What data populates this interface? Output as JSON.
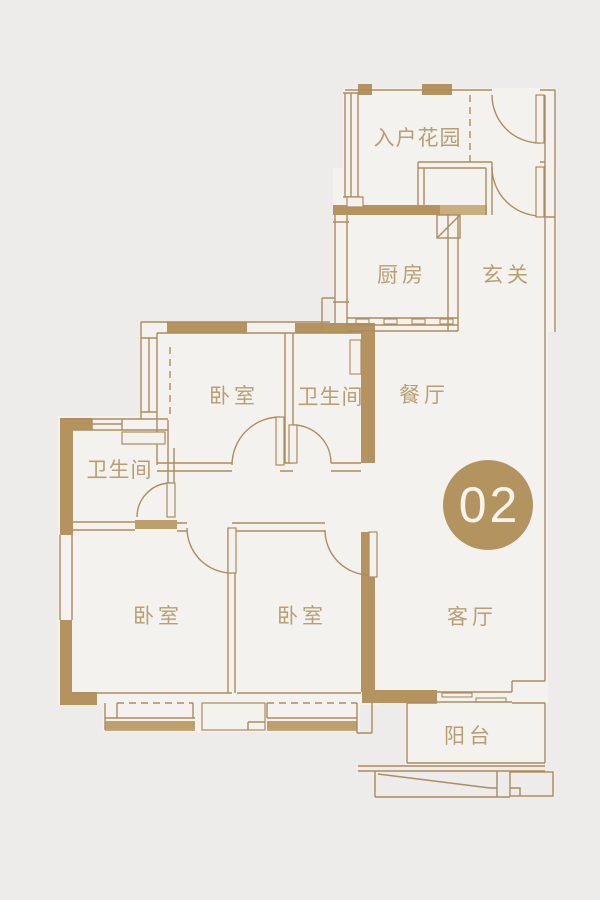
{
  "badge": {
    "number": "02"
  },
  "rooms": {
    "entry_garden": {
      "label": "入户花园"
    },
    "kitchen": {
      "label": "厨房"
    },
    "foyer": {
      "label": "玄关"
    },
    "bedroom_top": {
      "label": "卧室"
    },
    "bath_top": {
      "label": "卫生间"
    },
    "dining": {
      "label": "餐厅"
    },
    "bath_left": {
      "label": "卫生间"
    },
    "bedroom_left": {
      "label": "卧室"
    },
    "bedroom_mid": {
      "label": "卧室"
    },
    "living": {
      "label": "客厅"
    },
    "balcony": {
      "label": "阳台"
    }
  },
  "colors": {
    "background": "#edecea",
    "floor": "#f4f2ee",
    "line": "#ad8c5d",
    "wall": "#b4935f",
    "wall_light": "#c9af7e",
    "sill": "#bd9f6b",
    "label": "#b89f73",
    "badge_bg": "#b3945f",
    "badge_text": "#f7f4ee"
  }
}
